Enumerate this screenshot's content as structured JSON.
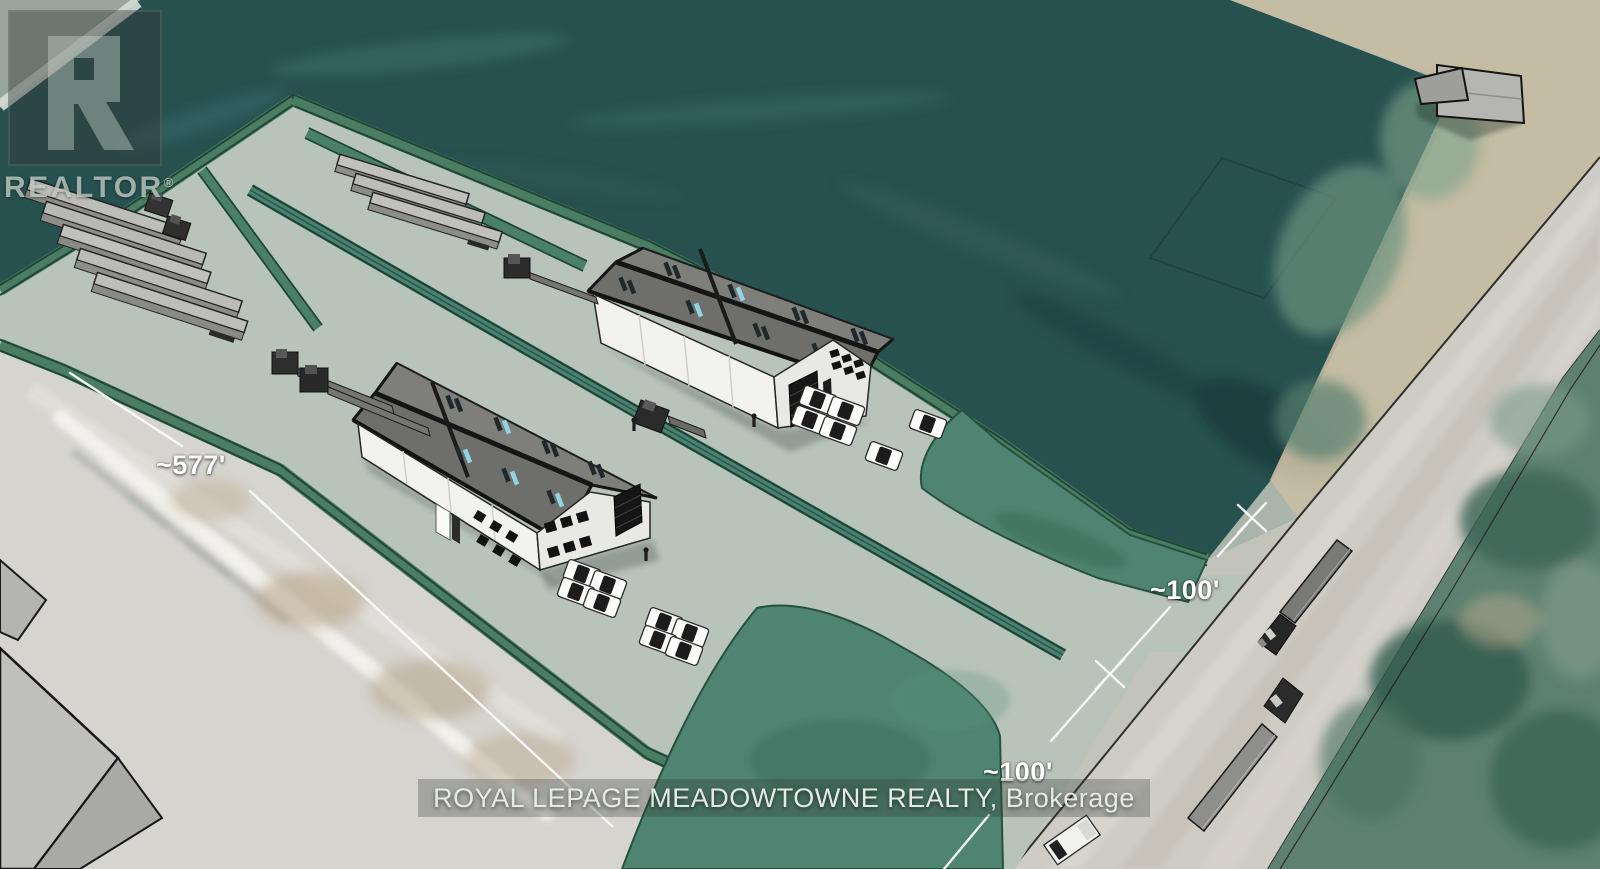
{
  "watermark": {
    "logo_letter": "R",
    "logo_text": "REALTOR",
    "registered_mark": "®"
  },
  "annotations": {
    "site_length_label": "~577'",
    "entrance_width_label": "~100'",
    "entrance_depth_label": "~100'"
  },
  "footer": {
    "brokerage_line": "ROYAL LEPAGE MEADOWTOWNE REALTY, Brokerage"
  },
  "colors": {
    "aerial_field_teal": "#27514f",
    "site_pavement_sage": "#b8c3b9",
    "landscape_green": "#4e8471",
    "hedge_green": "#4b7d63",
    "road_gray": "#cfccc5",
    "warehouse_wall": "#f2f2ef",
    "warehouse_roof": "#6e6e6b",
    "skylight_glint_cyan": "#93d4e4",
    "dimension_line_white": "#f8fbf9"
  },
  "scene": {
    "description_labels": {
      "proposed_buildings": 2,
      "neighbor_buildings": 1,
      "parked_trailers": 8,
      "dock_flatbed_trucks": 3,
      "yard_truck": 1,
      "parked_cars": 14,
      "road_semi_trucks": 2,
      "road_van": 1,
      "people": 3
    }
  }
}
